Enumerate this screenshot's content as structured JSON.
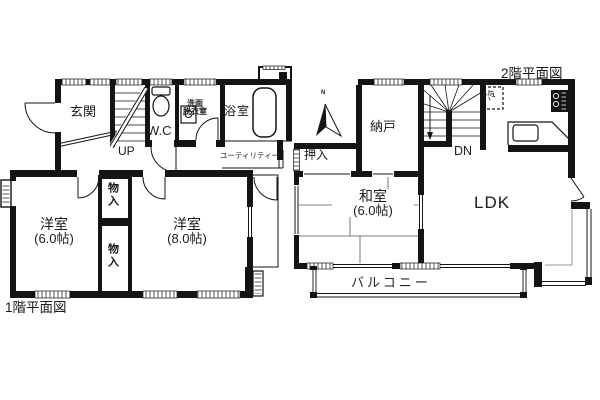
{
  "plan": {
    "floor1": {
      "title": "1階平面図",
      "entrance": "玄関",
      "wc": "W.C",
      "washroom_line1": "洗面",
      "washroom_line2": "脱衣室",
      "bathroom": "浴室",
      "utility": "ユーティリティー",
      "stairs_up": "UP",
      "closet_top": "物入",
      "closet_bottom": "物入",
      "western_room_small": "洋室",
      "western_room_small_size": "(6.0帖)",
      "western_room_large": "洋室",
      "western_room_large_size": "(8.0帖)"
    },
    "floor2": {
      "title": "2階平面図",
      "storage_room": "納戸",
      "stairs_down": "DN",
      "refrigerator": "冷",
      "closet": "押入",
      "japanese_room": "和室",
      "japanese_room_size": "(6.0帖)",
      "ldk": "LDK",
      "balcony": "バルコニー",
      "north_mark": "N"
    },
    "colors": {
      "wall": "#141414",
      "bg": "#ffffff",
      "tatami_line": "#555555"
    }
  }
}
